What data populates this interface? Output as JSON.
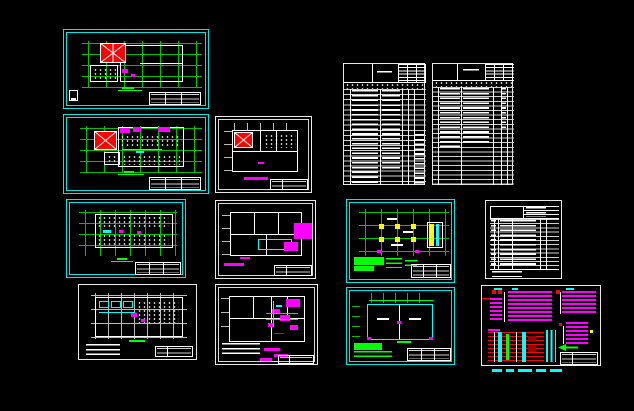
{
  "app": {
    "name": "CAD multi-sheet drawing view",
    "background_color": "#000000",
    "visible_text": "none legible (all drawing text rendered below readable size)"
  },
  "palette": {
    "frame_cyan": "#00e5e5",
    "line_white": "#ffffff",
    "grid_green": "#00ff00",
    "hatch_red": "#ff0000",
    "annotation_magenta": "#ff00ff",
    "column_yellow": "#ffff00",
    "dark_red": "#990000"
  },
  "sheets": [
    {
      "id": "roof-plan",
      "kind": "floor plan sheet - roof plan with red cross-hatched skylight on green column grid",
      "frame": "#00e5e5"
    },
    {
      "id": "equipment-plan-1",
      "kind": "floor plan sheet - equipment layout, red hatched bay, magenta labels",
      "frame": "#00e5e5"
    },
    {
      "id": "equipment-plan-2",
      "kind": "floor plan sheet - fixture layout rows on green grid",
      "frame": "#00e5e5"
    },
    {
      "id": "basement-plan",
      "kind": "floor plan sheet - white grid plan with cyan equipment blocks",
      "frame": "#ffffff"
    },
    {
      "id": "small-roof-plan",
      "kind": "floor plan sheet - small plan with red hatched roof bay",
      "frame": "#ffffff"
    },
    {
      "id": "power-plan",
      "kind": "floor plan sheet - plan with solid magenta highlighted zones and cyan room outline",
      "frame": "#ffffff"
    },
    {
      "id": "wiring-plan",
      "kind": "floor plan sheet - plan with dense magenta wiring annotations and green circuit lines",
      "frame": "#ffffff"
    },
    {
      "id": "schedule-table-1",
      "kind": "schedule / drawing-list table, dense unreadable text rows",
      "frame": "#ffffff"
    },
    {
      "id": "schedule-table-2",
      "kind": "schedule / drawing-list table, dense unreadable text rows",
      "frame": "#ffffff"
    },
    {
      "id": "column-grid-plan",
      "kind": "structural plan - yellow columns on green grid, green note paragraph",
      "frame": "#00e5e5"
    },
    {
      "id": "legend-table",
      "kind": "legend / title table with row grid",
      "frame": "#ffffff"
    },
    {
      "id": "room-outline-plan",
      "kind": "floor plan - cyan walls, green dimension strings, green note paragraph",
      "frame": "#00e5e5"
    },
    {
      "id": "distribution-diagram",
      "kind": "electrical distribution system diagram - magenta panel blocks, red bus lines, cyan risers, green arrow",
      "frame": "#ffffff"
    }
  ],
  "annotations": {
    "below_distribution_diagram": "row of small cyan text dashes"
  },
  "counts": {
    "sheets_total": 13,
    "cyan_framed_sheets": 5,
    "white_framed_sheets": 8,
    "schedule_tables": 3
  }
}
